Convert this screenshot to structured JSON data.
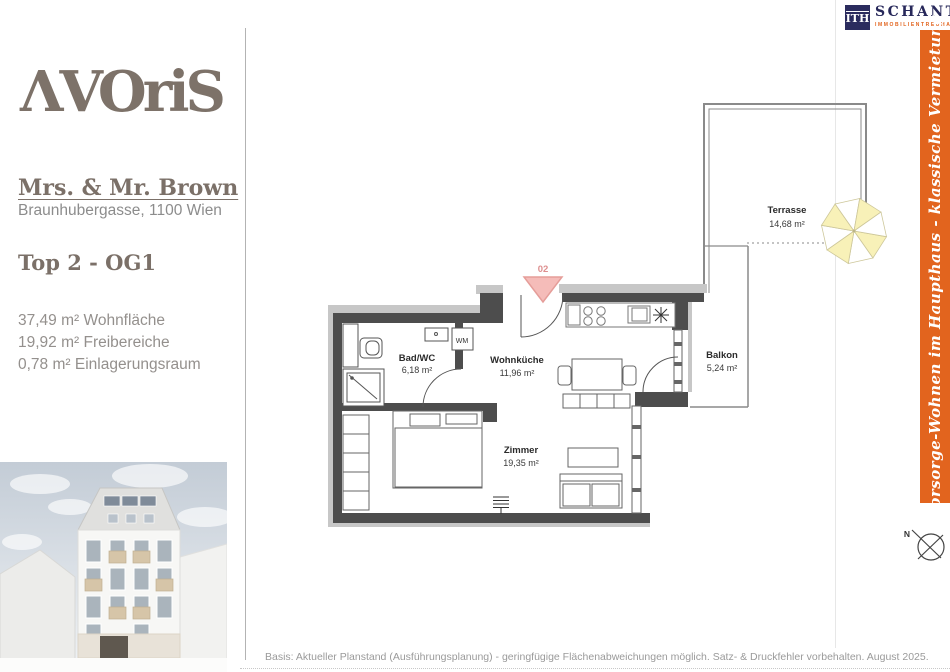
{
  "branding": {
    "logo_text": "ΛVOriS",
    "agency": {
      "abbr": "ITH",
      "name": "SCHANTL",
      "subtitle": "IMMOBILIENTREUHAND"
    }
  },
  "client": {
    "name": "Mrs. & Mr. Brown",
    "address": "Braunhubergasse, 1100 Wien"
  },
  "unit": {
    "label": "Top 2 - OG1",
    "areas": [
      "37,49 m² Wohnfläche",
      "19,92 m² Freibereiche",
      "0,78 m² Einlagerungsraum"
    ]
  },
  "side_banner": {
    "text": "Vorsorge-Wohnen im Haupthaus - klassische Vermietung",
    "color": "#e2641e"
  },
  "floor_plan": {
    "unit_number": "02",
    "rooms": [
      {
        "name": "Bad/WC",
        "area": "6,18 m²"
      },
      {
        "name": "Wohnküche",
        "area": "11,96 m²"
      },
      {
        "name": "Zimmer",
        "area": "19,35 m²"
      },
      {
        "name": "Balkon",
        "area": "5,24 m²"
      },
      {
        "name": "Terrasse",
        "area": "14,68 m²"
      }
    ],
    "appliance_label": "WM",
    "compass_label": "N"
  },
  "footer": {
    "disclaimer": "Basis: Aktueller Planstand (Ausführungsplanung) - geringfügige Flächenabweichungen möglich. Satz- & Druckfehler vorbehalten. August 2025."
  }
}
